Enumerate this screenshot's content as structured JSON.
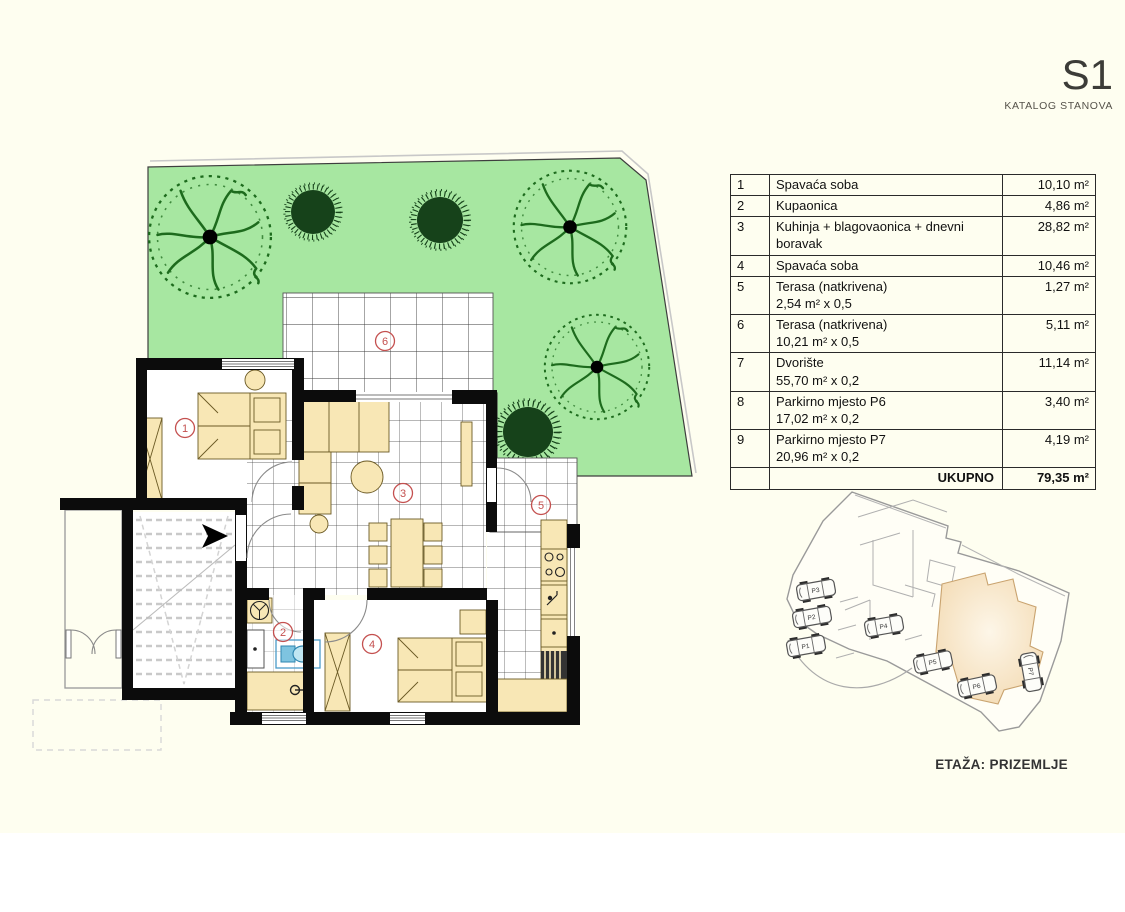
{
  "header": {
    "title": "S1",
    "subtitle": "KATALOG STANOVA"
  },
  "table": {
    "rows": [
      {
        "num": "1",
        "name": "Spavaća soba",
        "sub": "",
        "area": "10,10 m²"
      },
      {
        "num": "2",
        "name": "Kupaonica",
        "sub": "",
        "area": "4,86 m²"
      },
      {
        "num": "3",
        "name": "Kuhinja + blagovaonica + dnevni boravak",
        "sub": "",
        "area": "28,82 m²"
      },
      {
        "num": "4",
        "name": "Spavaća soba",
        "sub": "",
        "area": "10,46 m²"
      },
      {
        "num": "5",
        "name": "Terasa (natkrivena)",
        "sub": "2,54 m² x 0,5",
        "area": "1,27 m²"
      },
      {
        "num": "6",
        "name": "Terasa (natkrivena)",
        "sub": "10,21 m² x 0,5",
        "area": "5,11 m²"
      },
      {
        "num": "7",
        "name": "Dvorište",
        "sub": "55,70 m² x 0,2",
        "area": "11,14 m²"
      },
      {
        "num": "8",
        "name": "Parkirno mjesto P6",
        "sub": "17,02 m² x 0,2",
        "area": "3,40 m²"
      },
      {
        "num": "9",
        "name": "Parkirno mjesto P7",
        "sub": "20,96 m² x 0,2",
        "area": "4,19 m²"
      }
    ],
    "total_label": "UKUPNO",
    "total_area": "79,35 m²"
  },
  "floorplan": {
    "room_labels": [
      {
        "n": "1",
        "x": 185,
        "y": 428
      },
      {
        "n": "2",
        "x": 283,
        "y": 632
      },
      {
        "n": "3",
        "x": 403,
        "y": 493
      },
      {
        "n": "4",
        "x": 372,
        "y": 644
      },
      {
        "n": "5",
        "x": 541,
        "y": 505
      },
      {
        "n": "6",
        "x": 385,
        "y": 341
      }
    ]
  },
  "siteplan": {
    "caption": "ETAŽA: PRIZEMLJE",
    "parking": [
      {
        "label": "P1",
        "x": 806,
        "y": 646,
        "angle": -10
      },
      {
        "label": "P2",
        "x": 812,
        "y": 617,
        "angle": -10
      },
      {
        "label": "P3",
        "x": 816,
        "y": 590,
        "angle": -10
      },
      {
        "label": "P4",
        "x": 884,
        "y": 626,
        "angle": -10
      },
      {
        "label": "P5",
        "x": 933,
        "y": 662,
        "angle": -12
      },
      {
        "label": "P6",
        "x": 977,
        "y": 686,
        "angle": -12
      },
      {
        "label": "P7",
        "x": 1031,
        "y": 672,
        "angle": 80
      }
    ]
  },
  "colors": {
    "background": "#FEFEF0",
    "garden_green": "#A7E7A1",
    "wall_black": "#0c0c0c",
    "furniture_tan": "#F8E7B5",
    "room_label_red": "#c4504f",
    "highlight_unit_orange": "#f3dab2",
    "toilet_blue": "#bfe6f2"
  }
}
